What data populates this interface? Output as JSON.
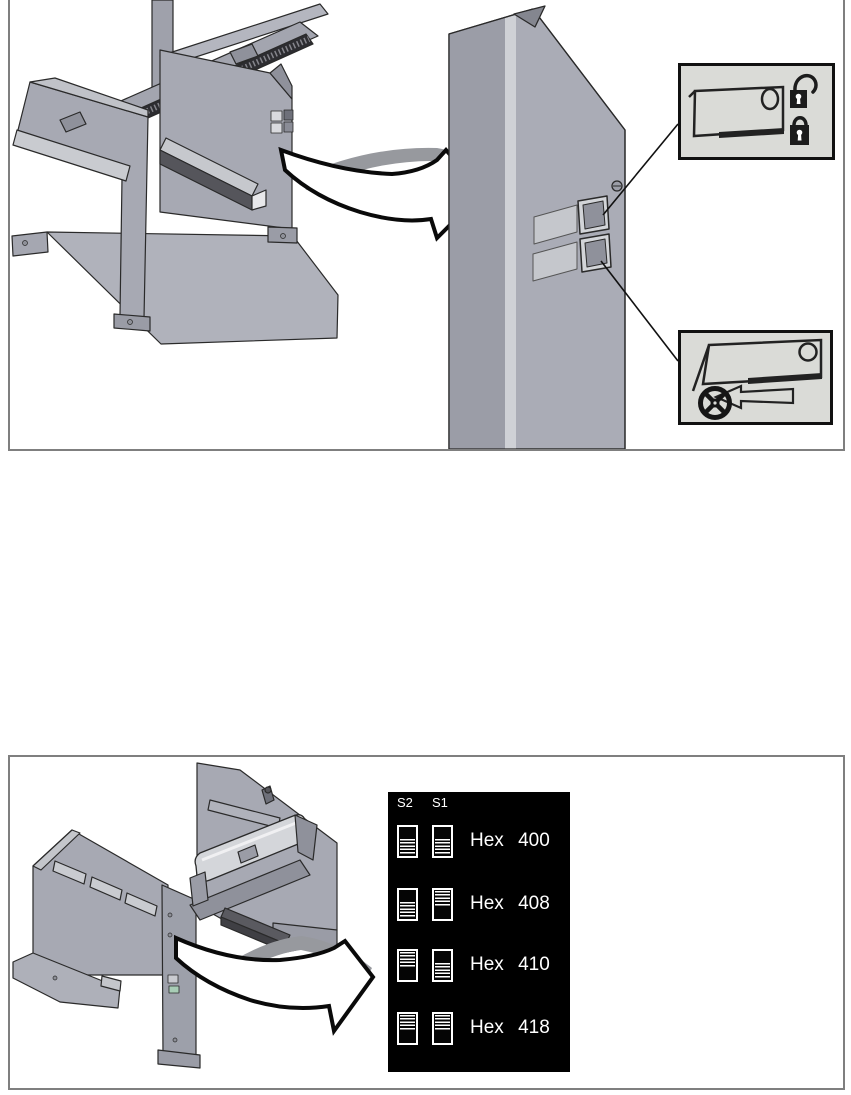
{
  "page": {
    "background_color": "#ffffff",
    "figure_border_color": "#7f7f7f"
  },
  "figure_top": {
    "machine": "library-frame-isometric",
    "enlargement": "corner-post-with-two-labels",
    "detail_box_locks": {
      "icons": [
        "door-panel-outline",
        "padlock-open",
        "padlock-locked"
      ]
    },
    "detail_box_wheel": {
      "icons": [
        "door-panel-outline",
        "arrow-left-outline",
        "handwheel"
      ]
    }
  },
  "figure_bottom": {
    "machine": "library-frame-isometric-rear",
    "switch_panel": {
      "background_color": "#000000",
      "text_color": "#ffffff",
      "columns": [
        "S2",
        "S1"
      ],
      "rows": [
        {
          "label": "Hex 400",
          "s2": "down",
          "s1": "down"
        },
        {
          "label": "Hex 408",
          "s2": "down",
          "s1": "up"
        },
        {
          "label": "Hex 410",
          "s2": "up",
          "s1": "down"
        },
        {
          "label": "Hex 418",
          "s2": "up",
          "s1": "up"
        }
      ]
    }
  },
  "colors": {
    "machine_gray": "#a9abb5",
    "machine_dark_gray": "#8f919b",
    "machine_light_gray": "#c9cbd0",
    "ribbon_gray": "#97999e",
    "comb_dark": "#2d2d31",
    "detail_box_bg": "#dadbd7",
    "outline": "#1a1a1a"
  }
}
